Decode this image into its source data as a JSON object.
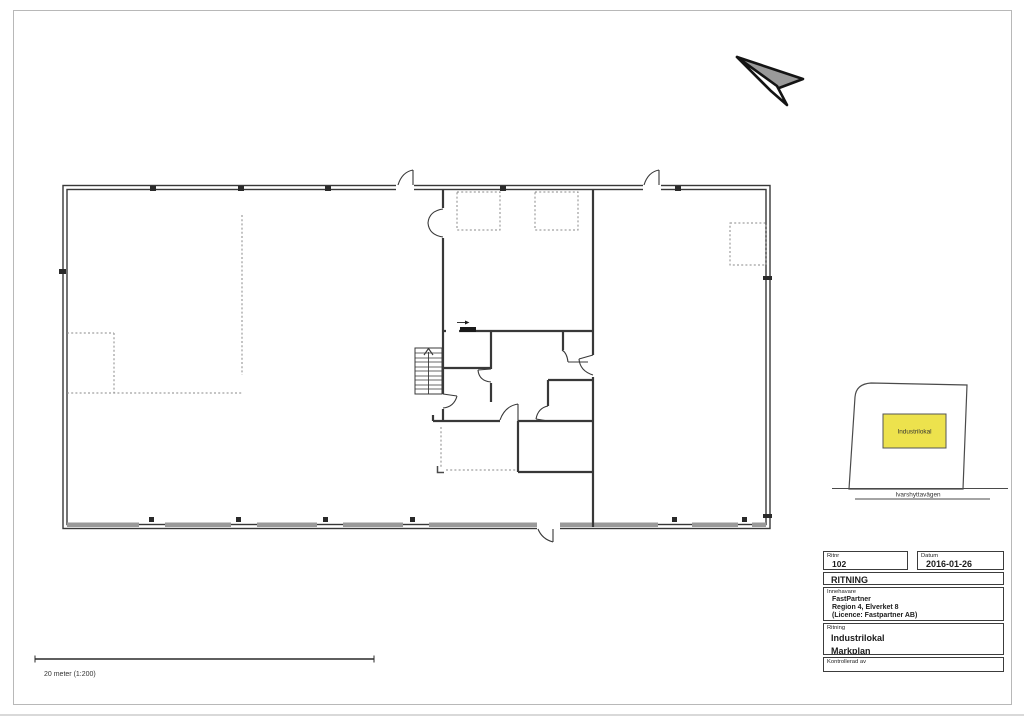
{
  "title_block": {
    "ritnr_label": "Ritnr",
    "ritnr_value": "102",
    "datum_label": "Datum",
    "datum_value": "2016-01-26",
    "header": "RITNING",
    "innehavare_label": "Innehavare",
    "innehavare_lines": [
      "FastPartner",
      "Region 4, Elverket 8",
      "(Licence: Fastpartner AB)"
    ],
    "ritning_label": "Ritning",
    "ritning_line1": "Industrilokal",
    "ritning_line2": "Markplan",
    "kontrollerad_label": "Kontrollerad av"
  },
  "site_map": {
    "building_label": "Industrilokal",
    "street_label": "Ivarshyttavägen",
    "building_fill": "#EDE24D"
  },
  "scale_bar": {
    "label": "20 meter (1:200)"
  },
  "icons": {
    "north_arrow": "north-arrow",
    "stairs": "stairs-symbol",
    "sliding_door_arrow": "slide-direction-arrow"
  },
  "drawing_colors": {
    "wall": "#383838",
    "dashed": "#8a8a8a",
    "window_band": "#9a9a9a"
  }
}
